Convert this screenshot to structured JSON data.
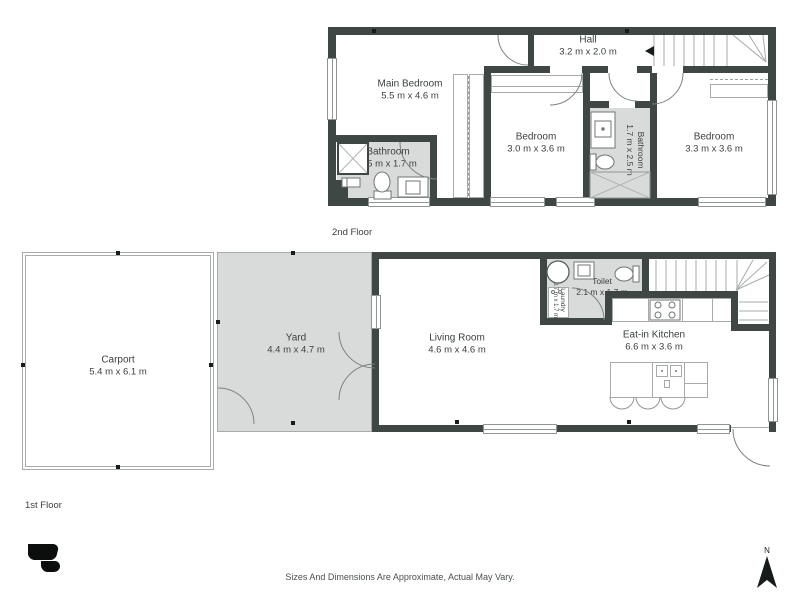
{
  "floors": {
    "second": {
      "label": "2nd Floor",
      "rooms": {
        "hall": {
          "name": "Hall",
          "dims": "3.2 m x 2.0 m"
        },
        "main_bedroom": {
          "name": "Main Bedroom",
          "dims": "5.5 m x 4.6 m"
        },
        "bathroom_left": {
          "name": "Bathroom",
          "dims": "2.5 m x 1.7 m"
        },
        "bedroom_center": {
          "name": "Bedroom",
          "dims": "3.0 m x 3.6 m"
        },
        "bathroom_center": {
          "name": "Bathroom",
          "dims": "1.7 m x 2.5 m"
        },
        "bedroom_right": {
          "name": "Bedroom",
          "dims": "3.3 m x 3.6 m"
        }
      }
    },
    "first": {
      "label": "1st Floor",
      "rooms": {
        "carport": {
          "name": "Carport",
          "dims": "5.4 m x 6.1 m"
        },
        "yard": {
          "name": "Yard",
          "dims": "4.4 m x 4.7 m"
        },
        "living_room": {
          "name": "Living Room",
          "dims": "4.6 m x 4.6 m"
        },
        "laundry": {
          "name": "Laundry",
          "dims": "0.7 m x 1.7 m"
        },
        "toilet": {
          "name": "Toilet",
          "dims": "2.1 m x 1.7 m"
        },
        "eat_in_kitchen": {
          "name": "Eat-in Kitchen",
          "dims": "6.6 m x 3.6 m"
        },
        "hwc": {
          "name": "HWC"
        }
      }
    }
  },
  "footer": {
    "disclaimer": "Sizes And Dimensions Are Approximate, Actual May Vary.",
    "north": "N"
  },
  "colors": {
    "wall": "#3e4744",
    "room_gray": "#d9dbda",
    "thin_outline": "#a6aba8",
    "text": "#3a403d"
  }
}
